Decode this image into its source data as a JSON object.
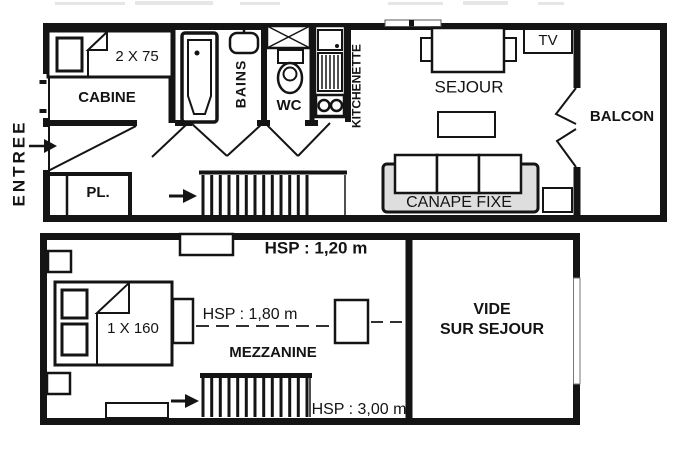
{
  "colors": {
    "ink": "#141414",
    "paper": "#ffffff",
    "sofa_fill": "#dedede"
  },
  "level1": {
    "entree_label": "ENTREE",
    "cabine_label": "CABINE",
    "cabine_bed_label": "2 X 75",
    "placard_label": "PL.",
    "bains_label": "BAINS",
    "wc_label": "WC",
    "kitchenette_label": "KITCHENETTE",
    "sejour_label": "SEJOUR",
    "tv_label": "TV",
    "sofa_label": "CANAPE FIXE",
    "balcon_label": "BALCON"
  },
  "level2": {
    "hsp_low": "HSP : 1,20 m",
    "bed_label": "1 X 160",
    "hsp_mid": "HSP : 1,80 m",
    "mezzanine_label": "MEZZANINE",
    "vide_line1": "VIDE",
    "vide_line2": "SUR SEJOUR",
    "hsp_high": "HSP : 3,00 m"
  },
  "symbols": {
    "entry_arrow": "right-arrow",
    "stairs_up_arrow": "right-arrow",
    "stairs_down_arrow": "right-arrow"
  }
}
